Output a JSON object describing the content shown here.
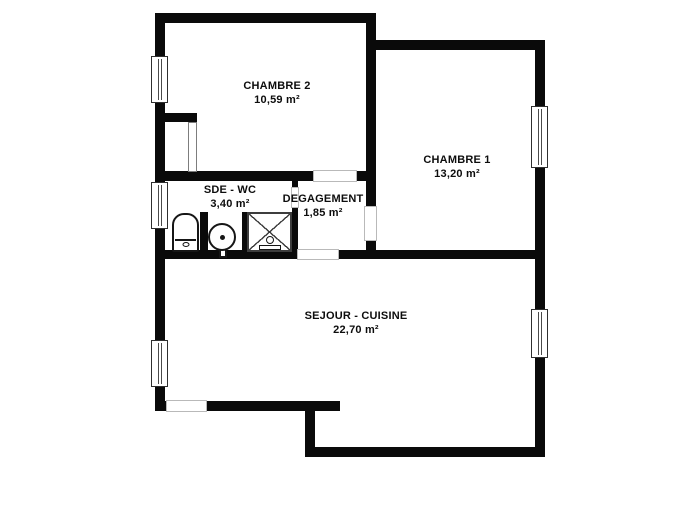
{
  "plan": {
    "canvas": {
      "w": 700,
      "h": 525,
      "bg": "#ffffff"
    },
    "wall_color": "#0a0a0a",
    "rooms": [
      {
        "name": "CHAMBRE 2",
        "area": "10,59 m²",
        "cx": 277,
        "cy": 93
      },
      {
        "name": "CHAMBRE 1",
        "area": "13,20 m²",
        "cx": 457,
        "cy": 167
      },
      {
        "name": "SDE - WC",
        "area": "3,40 m²",
        "cx": 230,
        "cy": 197
      },
      {
        "name": "DEGAGEMENT",
        "area": "1,85 m²",
        "cx": 323,
        "cy": 206
      },
      {
        "name": "SEJOUR - CUISINE",
        "area": "22,70 m²",
        "cx": 356,
        "cy": 323
      }
    ],
    "walls": [
      {
        "x": 155,
        "y": 13,
        "w": 221,
        "h": 10
      },
      {
        "x": 366,
        "y": 13,
        "w": 10,
        "h": 37
      },
      {
        "x": 366,
        "y": 40,
        "w": 178,
        "h": 10
      },
      {
        "x": 155,
        "y": 13,
        "w": 10,
        "h": 397
      },
      {
        "x": 535,
        "y": 40,
        "w": 10,
        "h": 417
      },
      {
        "x": 155,
        "y": 171,
        "w": 158,
        "h": 10
      },
      {
        "x": 357,
        "y": 171,
        "w": 19,
        "h": 10
      },
      {
        "x": 366,
        "y": 50,
        "w": 10,
        "h": 157
      },
      {
        "x": 366,
        "y": 240,
        "w": 10,
        "h": 19
      },
      {
        "x": 155,
        "y": 250,
        "w": 143,
        "h": 9
      },
      {
        "x": 338,
        "y": 250,
        "w": 206,
        "h": 9
      },
      {
        "x": 165,
        "y": 113,
        "w": 32,
        "h": 9
      },
      {
        "x": 292,
        "y": 180,
        "w": 6,
        "h": 7
      },
      {
        "x": 292,
        "y": 208,
        "w": 6,
        "h": 44
      },
      {
        "x": 242,
        "y": 212,
        "w": 6,
        "h": 40
      },
      {
        "x": 200,
        "y": 212,
        "w": 8,
        "h": 40
      },
      {
        "x": 155,
        "y": 401,
        "w": 185,
        "h": 10
      },
      {
        "x": 305,
        "y": 401,
        "w": 10,
        "h": 56
      },
      {
        "x": 305,
        "y": 447,
        "w": 239,
        "h": 10
      }
    ],
    "openings": [
      {
        "x": 313,
        "y": 170,
        "w": 44,
        "h": 12
      },
      {
        "x": 364,
        "y": 206,
        "w": 13,
        "h": 35
      },
      {
        "x": 291,
        "y": 187,
        "w": 8,
        "h": 21
      },
      {
        "x": 297,
        "y": 249,
        "w": 42,
        "h": 11
      },
      {
        "x": 166,
        "y": 400,
        "w": 41,
        "h": 12
      }
    ],
    "windows": [
      {
        "x": 151,
        "y": 56,
        "w": 17,
        "h": 47
      },
      {
        "x": 151,
        "y": 182,
        "w": 17,
        "h": 47
      },
      {
        "x": 151,
        "y": 340,
        "w": 17,
        "h": 47
      },
      {
        "x": 531,
        "y": 106,
        "w": 17,
        "h": 62
      },
      {
        "x": 531,
        "y": 309,
        "w": 17,
        "h": 49
      }
    ],
    "door_leaves": [
      {
        "x": 188,
        "y": 122,
        "w": 9,
        "h": 50
      }
    ],
    "fixtures": {
      "toilet": {
        "x": 172,
        "y": 213,
        "w": 27,
        "h": 39
      },
      "sink": {
        "x": 208,
        "y": 223,
        "d": 28,
        "dot": {
          "x": 220,
          "y": 235,
          "w": 5,
          "h": 5
        },
        "stem": {
          "x": 219,
          "y": 247,
          "w": 8,
          "h": 11
        }
      },
      "shower": {
        "x": 247,
        "y": 212,
        "w": 45,
        "h": 40,
        "head_circle": {
          "x": 266,
          "y": 236,
          "w": 8,
          "h": 8
        },
        "head_base": {
          "x": 259,
          "y": 245,
          "w": 22,
          "h": 5
        }
      }
    }
  }
}
